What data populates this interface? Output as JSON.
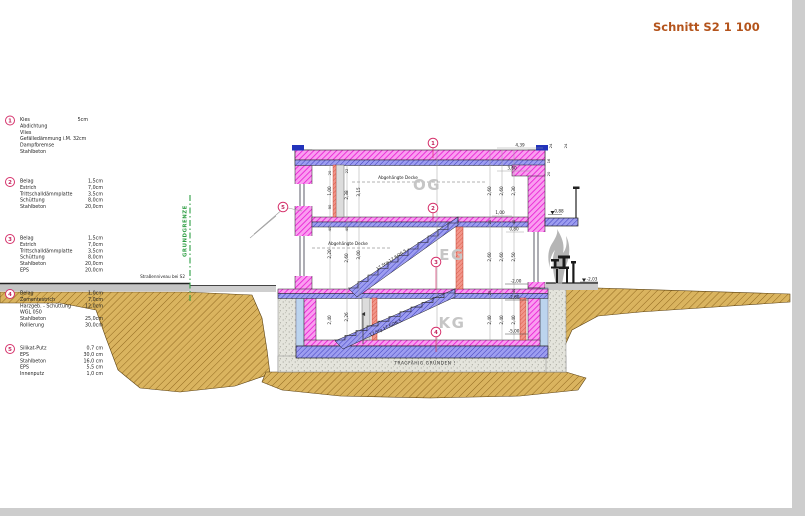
{
  "title": "Schnitt S2 1 100",
  "legend": {
    "items": [
      {
        "num": "1",
        "rows": [
          {
            "m": "Kies",
            "v": "5cm"
          },
          {
            "m": "Abdichtung",
            "v": ""
          },
          {
            "m": "Vlies",
            "v": ""
          },
          {
            "m": "Gefälledämmung i.M. 32cm",
            "v": ""
          },
          {
            "m": "Dampfbremse",
            "v": ""
          },
          {
            "m": "Stahlbeton",
            "v": ""
          }
        ]
      },
      {
        "num": "2",
        "rows": [
          {
            "m": "Belag",
            "v": "1,5cm"
          },
          {
            "m": "Estrich",
            "v": "7,0cm"
          },
          {
            "m": "Trittschalldämmplatte",
            "v": "3,5cm"
          },
          {
            "m": "Schüttung",
            "v": "8,0cm"
          },
          {
            "m": "Stahlbeton",
            "v": "20,0cm"
          }
        ]
      },
      {
        "num": "3",
        "rows": [
          {
            "m": "Belag",
            "v": "1,5cm"
          },
          {
            "m": "Estrich",
            "v": "7,0cm"
          },
          {
            "m": "Trittschalldämmplatte",
            "v": "3,5cm"
          },
          {
            "m": "Schüttung",
            "v": "8,0cm"
          },
          {
            "m": "Stahlbeton",
            "v": "20,0cm"
          },
          {
            "m": "EPS",
            "v": "20,0cm"
          }
        ]
      },
      {
        "num": "4",
        "rows": [
          {
            "m": "Belag",
            "v": "1,0cm"
          },
          {
            "m": "Zementestrich",
            "v": "7,0cm"
          },
          {
            "m": "Harzgeb. - Schüttung",
            "v": "12,0cm"
          },
          {
            "m": "WGL 050",
            "v": ""
          },
          {
            "m": "Stahlbeton",
            "v": "25,0cm"
          },
          {
            "m": "Rollierung",
            "v": "30,0cm"
          }
        ]
      },
      {
        "num": "5",
        "rows": [
          {
            "m": "Silikat-Putz",
            "v": "0,7 cm"
          },
          {
            "m": "EPS",
            "v": "30,0 cm"
          },
          {
            "m": "Stahlbeton",
            "v": "16,0 cm"
          },
          {
            "m": "EPS",
            "v": "5,5 cm"
          },
          {
            "m": "Innenputz",
            "v": "1,0 cm"
          }
        ]
      }
    ]
  },
  "drawing": {
    "floor_labels": {
      "og": "OG",
      "eg": "EG",
      "kg": "KG"
    },
    "annotations": {
      "suspended_ceiling_og": "Abgehängte Decke",
      "suspended_ceiling_eg": "Abgehängte Decke",
      "stairs_upper": "17 Stg 17,6/26,5",
      "stairs_lower": "17 Stg 17,6/26,5",
      "foundation_note": "TRAGFÄHIG GRÜNDEN !",
      "street_level": "Straßenniveau bei S2",
      "property_line": "GRUNDGRENZE"
    },
    "callouts": {
      "c1": "1",
      "c2": "2",
      "c3": "3",
      "c4": "4",
      "c5": "5"
    },
    "levels": {
      "og_floor": "0,88",
      "eg_floor": "-2,00",
      "kg_ceiling": "-2,60",
      "kg_floor": "-5,00",
      "terrace": "-2,03"
    },
    "dims": {
      "roof_width": "4,39",
      "og_width": "3,60",
      "og_opening": "1,00",
      "parapet": "0,80",
      "w20a": "20",
      "h100": "1,00",
      "w90": "90",
      "w40a": "40",
      "h220": "2,20",
      "h240a": "2,40",
      "w22": "22",
      "h238": "2,38",
      "w40b": "40",
      "h260a": "2,60",
      "h226": "2,26",
      "h315": "3,15",
      "h300": "3,00",
      "h260b": "2,60",
      "w20b": "20",
      "h260c": "2,60",
      "w20c": "20",
      "h240b": "2,40",
      "h260d": "2,60",
      "h260e": "2,60",
      "h240c": "2,40",
      "h230": "2,30",
      "w40c": "40",
      "h250": "2,50",
      "w40d": "40",
      "h240d": "2,40",
      "w24a": "24",
      "w24b": "24",
      "w16": "16",
      "w20d": "20"
    }
  },
  "colors": {
    "wall_magenta": "#ee16d4",
    "slab_blue": "#7d7de8",
    "earth": "#d9b264",
    "callout": "#d6336c",
    "title": "#b4541c",
    "property_line_green": "#2f9e44",
    "red_column": "#ef8070"
  }
}
